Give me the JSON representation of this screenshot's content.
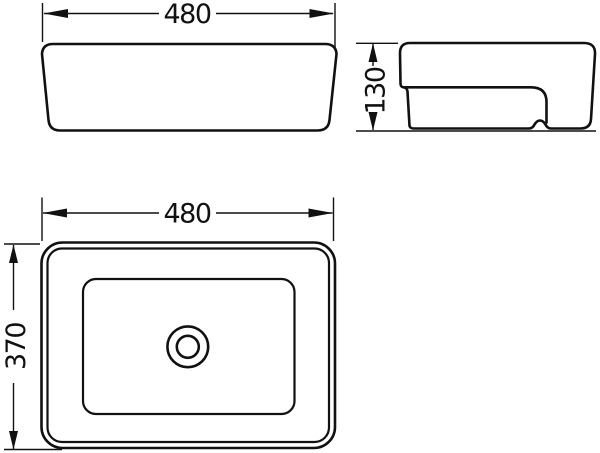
{
  "drawing": {
    "type": "technical-dimension-drawing",
    "subject": "rectangular-vessel-basin",
    "views": {
      "front": {
        "name": "front-view"
      },
      "side": {
        "name": "side-view"
      },
      "plan": {
        "name": "plan-view"
      }
    },
    "dimensions": {
      "front_width": {
        "value": "480"
      },
      "side_height": {
        "value": "130"
      },
      "plan_width": {
        "value": "480"
      },
      "plan_depth": {
        "value": "370"
      }
    },
    "colors": {
      "line": "#111111",
      "background": "#ffffff"
    }
  }
}
